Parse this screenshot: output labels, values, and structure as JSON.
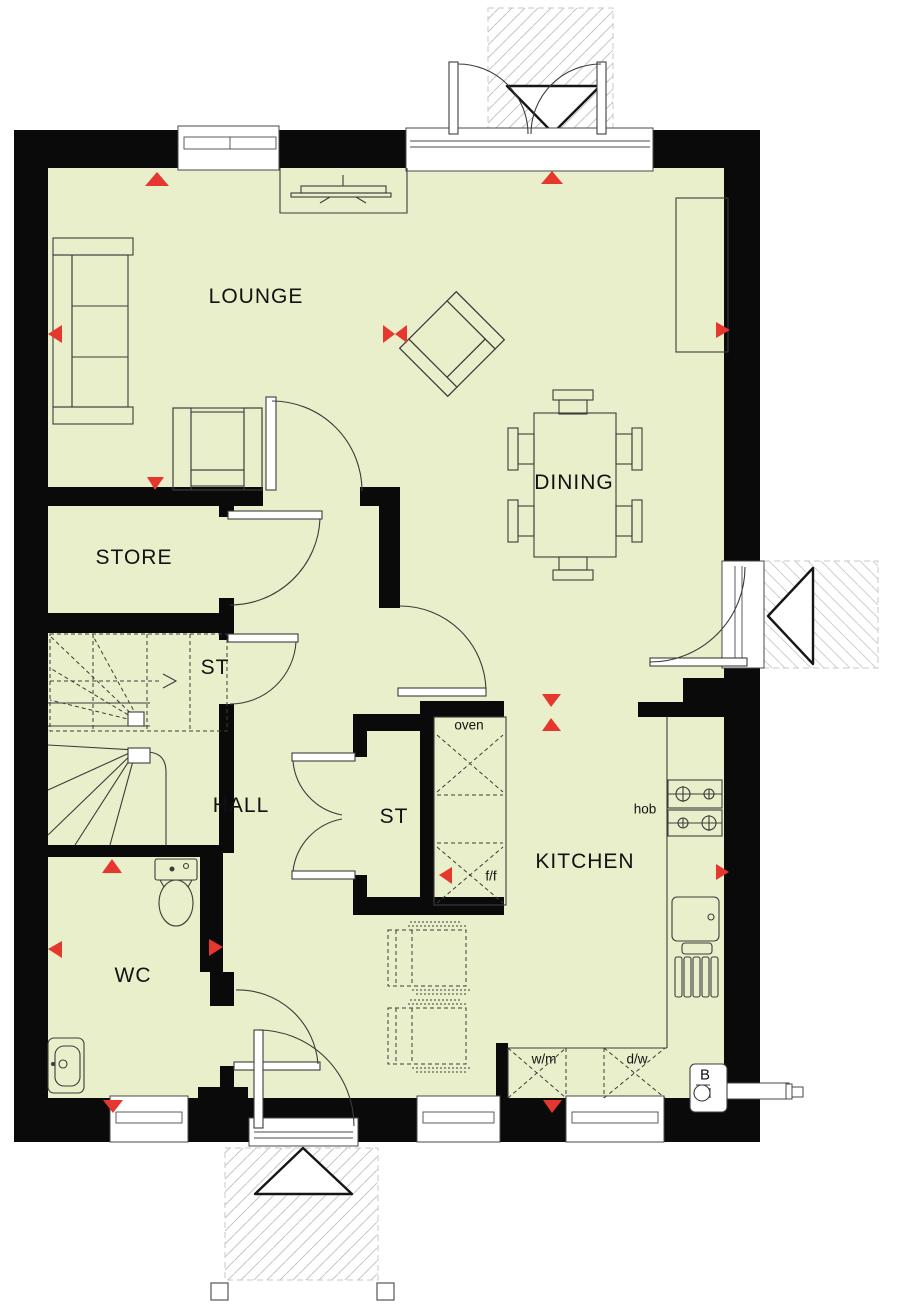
{
  "drawing": {
    "type": "ground-floor plan",
    "colors": {
      "floor": "#e9efca",
      "wall": "#0a0a0a",
      "marker_red": "#e6372e",
      "line": "#3c3c3c"
    }
  },
  "rooms": {
    "lounge": {
      "label": "LOUNGE"
    },
    "dining": {
      "label": "DINING"
    },
    "store": {
      "label": "STORE"
    },
    "stairs_store": {
      "label": "ST"
    },
    "hall": {
      "label": "HALL"
    },
    "hall_store": {
      "label": "ST"
    },
    "kitchen": {
      "label": "KITCHEN"
    },
    "wc": {
      "label": "WC"
    }
  },
  "fixtures": {
    "oven": {
      "label": "oven"
    },
    "hob": {
      "label": "hob"
    },
    "fridge_freezer": {
      "label": "f/f"
    },
    "washing_machine": {
      "label": "w/m"
    },
    "dishwasher": {
      "label": "d/w"
    },
    "boiler": {
      "label": "B"
    }
  }
}
